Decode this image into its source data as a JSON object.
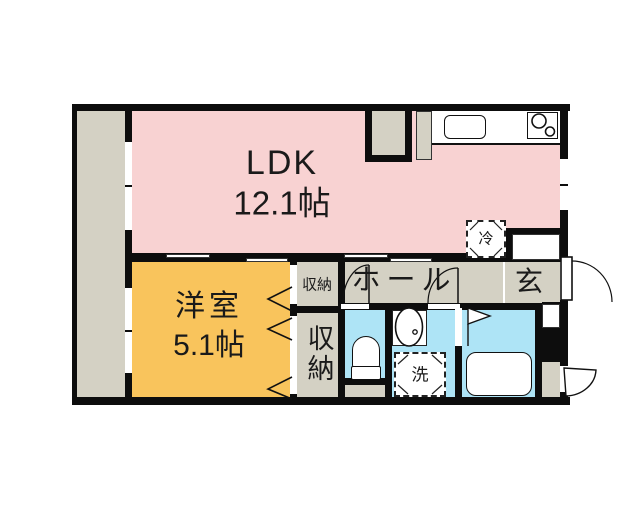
{
  "colors": {
    "wall": "#0d0d0d",
    "pink": "#f8d2d2",
    "orange": "#f9c45c",
    "cyan": "#aee4f6",
    "gray": "#d4d1c4",
    "ink": "#1a1a1a"
  },
  "rooms": {
    "ldk": {
      "name": "LDK",
      "area": "12.1帖"
    },
    "western": {
      "name": "洋室",
      "area": "5.1帖"
    },
    "hall": {
      "name": "ホール"
    },
    "entrance": {
      "name": "玄"
    },
    "storage_upper": {
      "name": "収納"
    },
    "storage_lower": {
      "name": "収納"
    },
    "fridge": {
      "name": "冷"
    },
    "laundry": {
      "name": "洗"
    }
  },
  "fixtures": {
    "kitchen_sink": "kitchen-sink",
    "stove": "two-burner-stove",
    "toilet": "toilet",
    "washbasin": "washbasin",
    "bathtub": "bathtub",
    "fridge_space": "refrigerator-space",
    "laundry_space": "washing-machine-space"
  }
}
